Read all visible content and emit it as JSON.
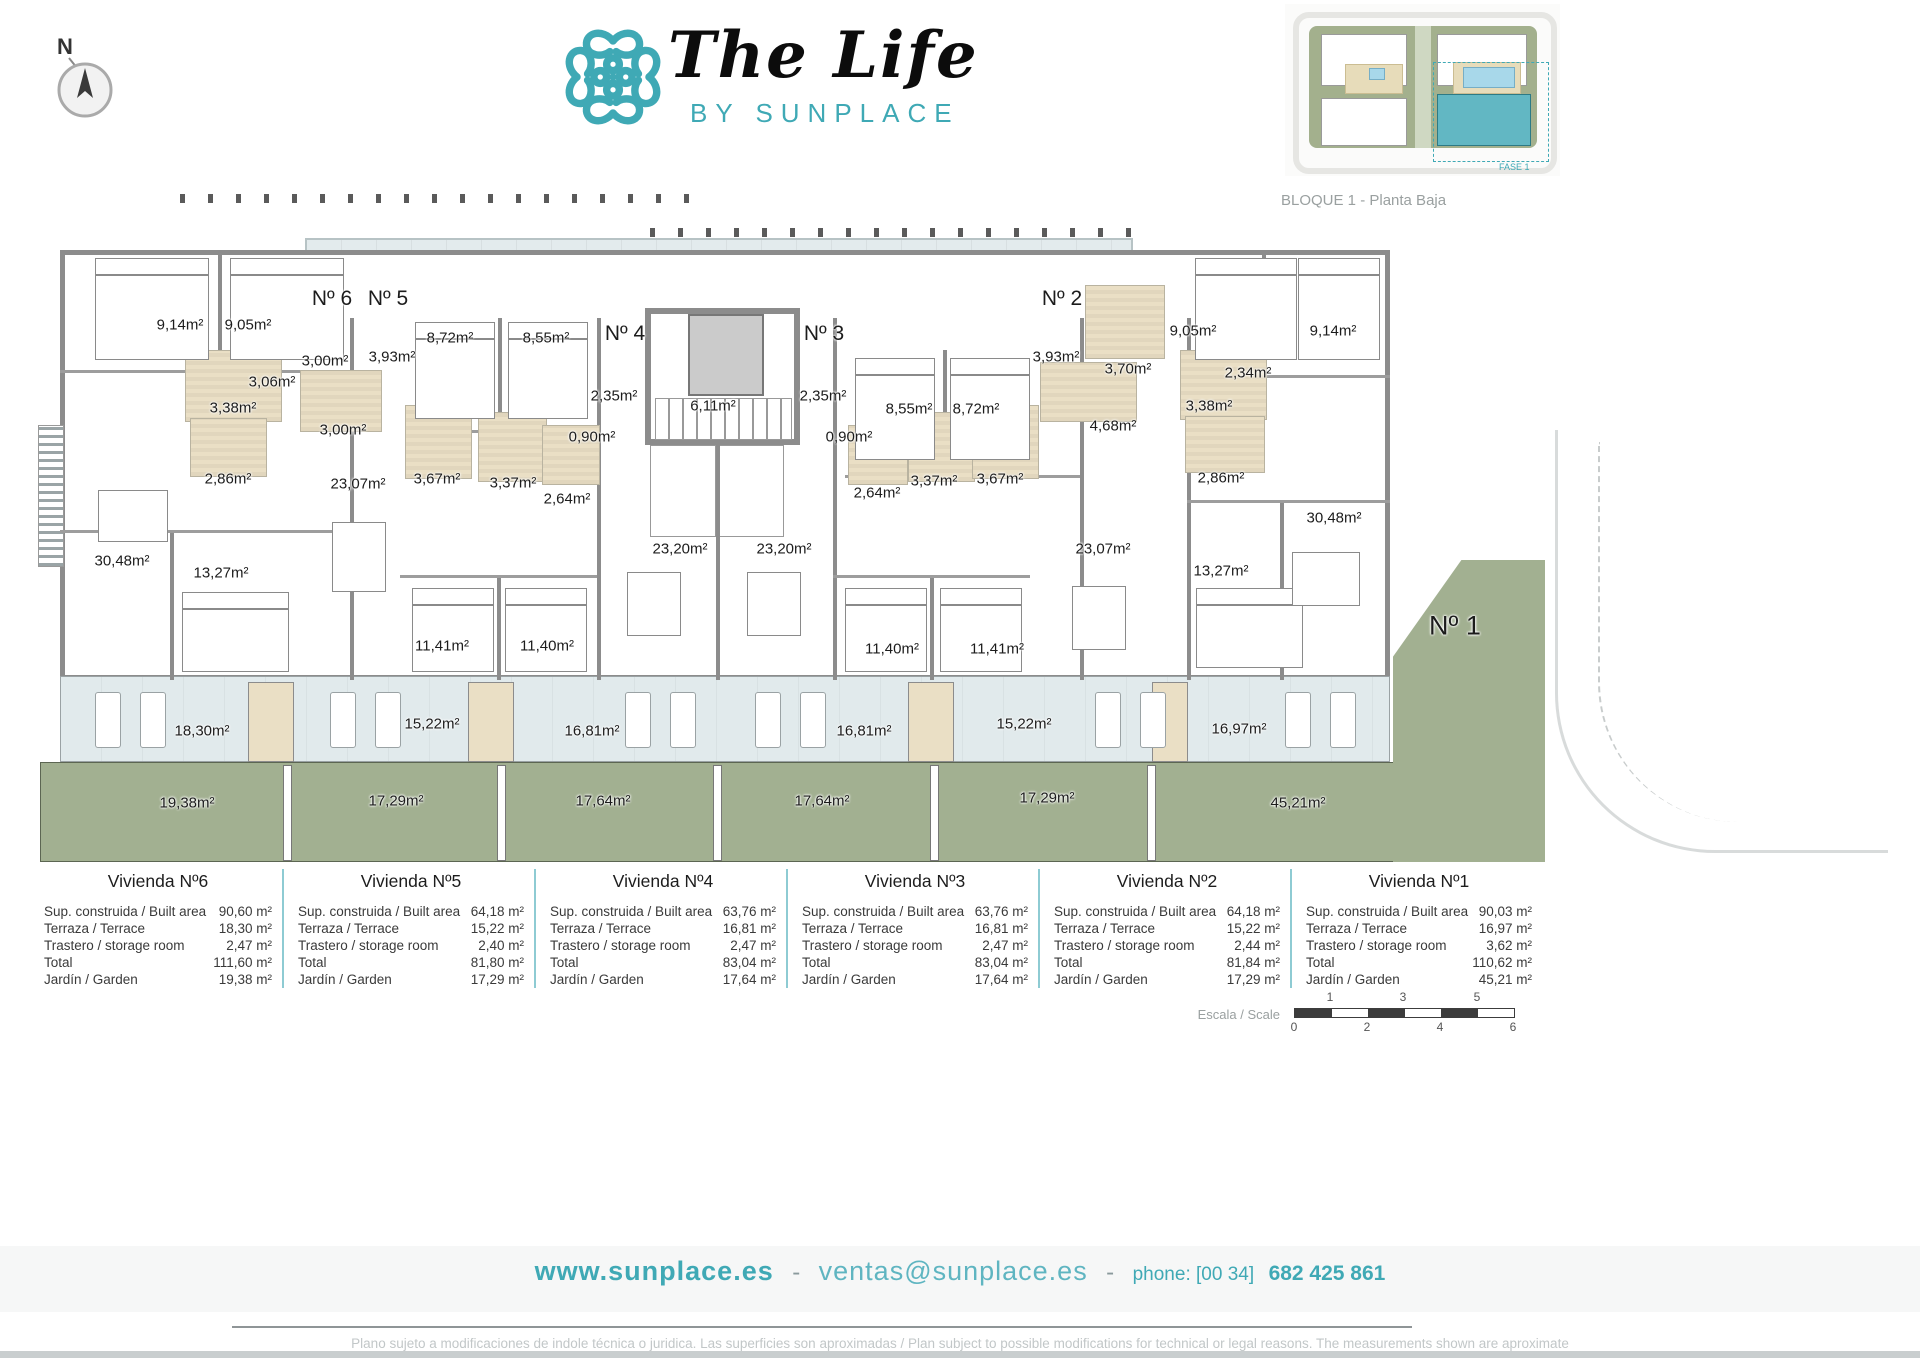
{
  "brand": {
    "title": "The Life",
    "subtitle": "BY SUNPLACE",
    "accent_color": "#3fa9b5"
  },
  "compass": {
    "label": "N"
  },
  "sitemap": {
    "caption": "BLOQUE 1 - Planta Baja",
    "phase_label": "FASE 1"
  },
  "plan": {
    "entrances": [
      {
        "label": "Nº 6",
        "x": 332,
        "y": 109
      },
      {
        "label": "Nº 5",
        "x": 388,
        "y": 109
      },
      {
        "label": "Nº 4",
        "x": 625,
        "y": 144
      },
      {
        "label": "Nº 3",
        "x": 824,
        "y": 144
      },
      {
        "label": "Nº 2",
        "x": 1062,
        "y": 109
      },
      {
        "label": "Nº 1",
        "x": 1455,
        "y": 436,
        "size": "lg"
      }
    ],
    "rooms": [
      {
        "label": "9,14m²",
        "x": 180,
        "y": 135
      },
      {
        "label": "9,05m²",
        "x": 248,
        "y": 135
      },
      {
        "label": "3,06m²",
        "x": 272,
        "y": 192
      },
      {
        "label": "3,00m²",
        "x": 325,
        "y": 171
      },
      {
        "label": "3,93m²",
        "x": 392,
        "y": 167
      },
      {
        "label": "8,72m²",
        "x": 450,
        "y": 148
      },
      {
        "label": "8,55m²",
        "x": 546,
        "y": 148
      },
      {
        "label": "2,35m²",
        "x": 614,
        "y": 206
      },
      {
        "label": "6,11m²",
        "x": 713,
        "y": 216
      },
      {
        "label": "2,35m²",
        "x": 823,
        "y": 206
      },
      {
        "label": "0,90m²",
        "x": 592,
        "y": 247
      },
      {
        "label": "0,90m²",
        "x": 849,
        "y": 247
      },
      {
        "label": "8,55m²",
        "x": 909,
        "y": 219
      },
      {
        "label": "8,72m²",
        "x": 976,
        "y": 219
      },
      {
        "label": "3,93m²",
        "x": 1056,
        "y": 167
      },
      {
        "label": "3,70m²",
        "x": 1128,
        "y": 179
      },
      {
        "label": "9,05m²",
        "x": 1193,
        "y": 141
      },
      {
        "label": "9,14m²",
        "x": 1333,
        "y": 141
      },
      {
        "label": "2,34m²",
        "x": 1248,
        "y": 183
      },
      {
        "label": "3,38m²",
        "x": 233,
        "y": 218
      },
      {
        "label": "3,00m²",
        "x": 343,
        "y": 240
      },
      {
        "label": "4,68m²",
        "x": 1113,
        "y": 236
      },
      {
        "label": "3,38m²",
        "x": 1209,
        "y": 216
      },
      {
        "label": "2,86m²",
        "x": 228,
        "y": 289
      },
      {
        "label": "23,07m²",
        "x": 358,
        "y": 294
      },
      {
        "label": "3,67m²",
        "x": 437,
        "y": 289
      },
      {
        "label": "3,37m²",
        "x": 513,
        "y": 293
      },
      {
        "label": "2,64m²",
        "x": 567,
        "y": 309
      },
      {
        "label": "2,64m²",
        "x": 877,
        "y": 303
      },
      {
        "label": "3,37m²",
        "x": 934,
        "y": 291
      },
      {
        "label": "3,67m²",
        "x": 1000,
        "y": 289
      },
      {
        "label": "23,07m²",
        "x": 1103,
        "y": 359
      },
      {
        "label": "2,86m²",
        "x": 1221,
        "y": 288
      },
      {
        "label": "23,20m²",
        "x": 680,
        "y": 359
      },
      {
        "label": "23,20m²",
        "x": 784,
        "y": 359
      },
      {
        "label": "30,48m²",
        "x": 122,
        "y": 371
      },
      {
        "label": "13,27m²",
        "x": 221,
        "y": 383
      },
      {
        "label": "11,41m²",
        "x": 442,
        "y": 456
      },
      {
        "label": "11,40m²",
        "x": 547,
        "y": 456
      },
      {
        "label": "11,40m²",
        "x": 892,
        "y": 459
      },
      {
        "label": "11,41m²",
        "x": 997,
        "y": 459
      },
      {
        "label": "13,27m²",
        "x": 1221,
        "y": 381
      },
      {
        "label": "30,48m²",
        "x": 1334,
        "y": 328
      }
    ],
    "terraces": [
      {
        "label": "18,30m²",
        "x": 202,
        "y": 541
      },
      {
        "label": "15,22m²",
        "x": 432,
        "y": 534
      },
      {
        "label": "16,81m²",
        "x": 592,
        "y": 541
      },
      {
        "label": "16,81m²",
        "x": 864,
        "y": 541
      },
      {
        "label": "15,22m²",
        "x": 1024,
        "y": 534
      },
      {
        "label": "16,97m²",
        "x": 1239,
        "y": 539
      }
    ],
    "gardens": [
      {
        "label": "19,38m²",
        "x": 187,
        "y": 613
      },
      {
        "label": "17,29m²",
        "x": 396,
        "y": 611
      },
      {
        "label": "17,64m²",
        "x": 603,
        "y": 611
      },
      {
        "label": "17,64m²",
        "x": 822,
        "y": 611
      },
      {
        "label": "17,29m²",
        "x": 1047,
        "y": 608
      },
      {
        "label": "45,21m²",
        "x": 1298,
        "y": 613
      }
    ]
  },
  "tables": {
    "row_labels": [
      "Sup. construida / Built area",
      "Terraza / Terrace",
      "Trastero / storage room",
      "Total",
      "Jardín / Garden"
    ],
    "units": [
      {
        "title": "Vivienda Nº6",
        "values": [
          "90,60 m²",
          "18,30 m²",
          "2,47 m²",
          "111,60 m²",
          "19,38 m²"
        ]
      },
      {
        "title": "Vivienda Nº5",
        "values": [
          "64,18 m²",
          "15,22 m²",
          "2,40 m²",
          "81,80 m²",
          "17,29 m²"
        ]
      },
      {
        "title": "Vivienda Nº4",
        "values": [
          "63,76 m²",
          "16,81 m²",
          "2,47 m²",
          "83,04 m²",
          "17,64 m²"
        ]
      },
      {
        "title": "Vivienda Nº3",
        "values": [
          "63,76 m²",
          "16,81 m²",
          "2,47 m²",
          "83,04 m²",
          "17,64 m²"
        ]
      },
      {
        "title": "Vivienda Nº2",
        "values": [
          "64,18 m²",
          "15,22 m²",
          "2,44 m²",
          "81,84 m²",
          "17,29 m²"
        ]
      },
      {
        "title": "Vivienda Nº1",
        "values": [
          "90,03 m²",
          "16,97 m²",
          "3,62 m²",
          "110,62 m²",
          "45,21 m²"
        ]
      }
    ]
  },
  "scale": {
    "label": "Escala / Scale",
    "top_ticks": [
      "1",
      "3",
      "5"
    ],
    "bottom_ticks": [
      "0",
      "2",
      "4",
      "6"
    ]
  },
  "footer": {
    "website": "www.sunplace.es",
    "separator": "-",
    "email": "ventas@sunplace.es",
    "phone_prefix": "phone: [00 34]",
    "phone_number": "682 425 861",
    "disclaimer": "Plano sujeto a modificaciones de indole técnica o juridica. Las superficies son aproximadas / Plan subject to possible modifications for technical or legal reasons. The measurements  shown are aproximate"
  }
}
